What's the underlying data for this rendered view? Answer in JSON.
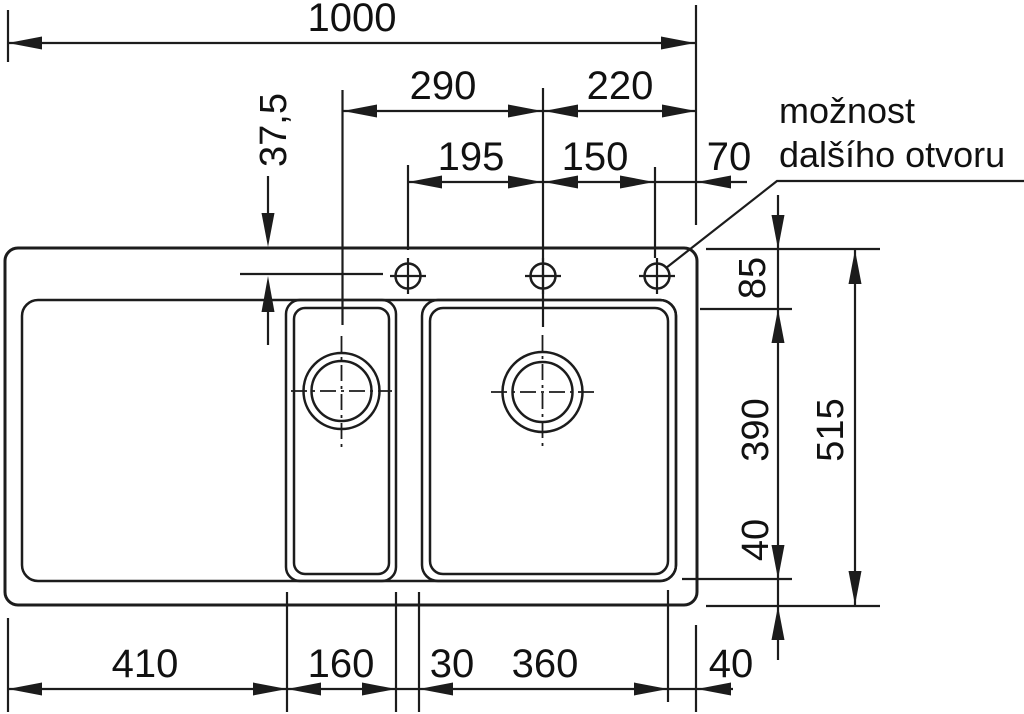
{
  "note": {
    "line1": "možnost",
    "line2": "dalšího otvoru"
  },
  "dims": {
    "overall_width": "1000",
    "left_to_center": "290",
    "center_to_right_edge": "220",
    "hole1_to_center": "195",
    "center_to_hole3": "150",
    "hole3_to_edge": "70",
    "top_edge_to_holes": "37,5",
    "rim_to_bowl_top": "85",
    "bowl_depth": "390",
    "bowl_to_bottom_edge": "40",
    "overall_depth": "515",
    "drainer_width": "410",
    "small_bowl_width": "160",
    "divider_width": "30",
    "main_bowl_width": "360",
    "bowl_to_right_edge": "40"
  },
  "colors": {
    "line": "#1c1c1c",
    "background": "#ffffff"
  }
}
